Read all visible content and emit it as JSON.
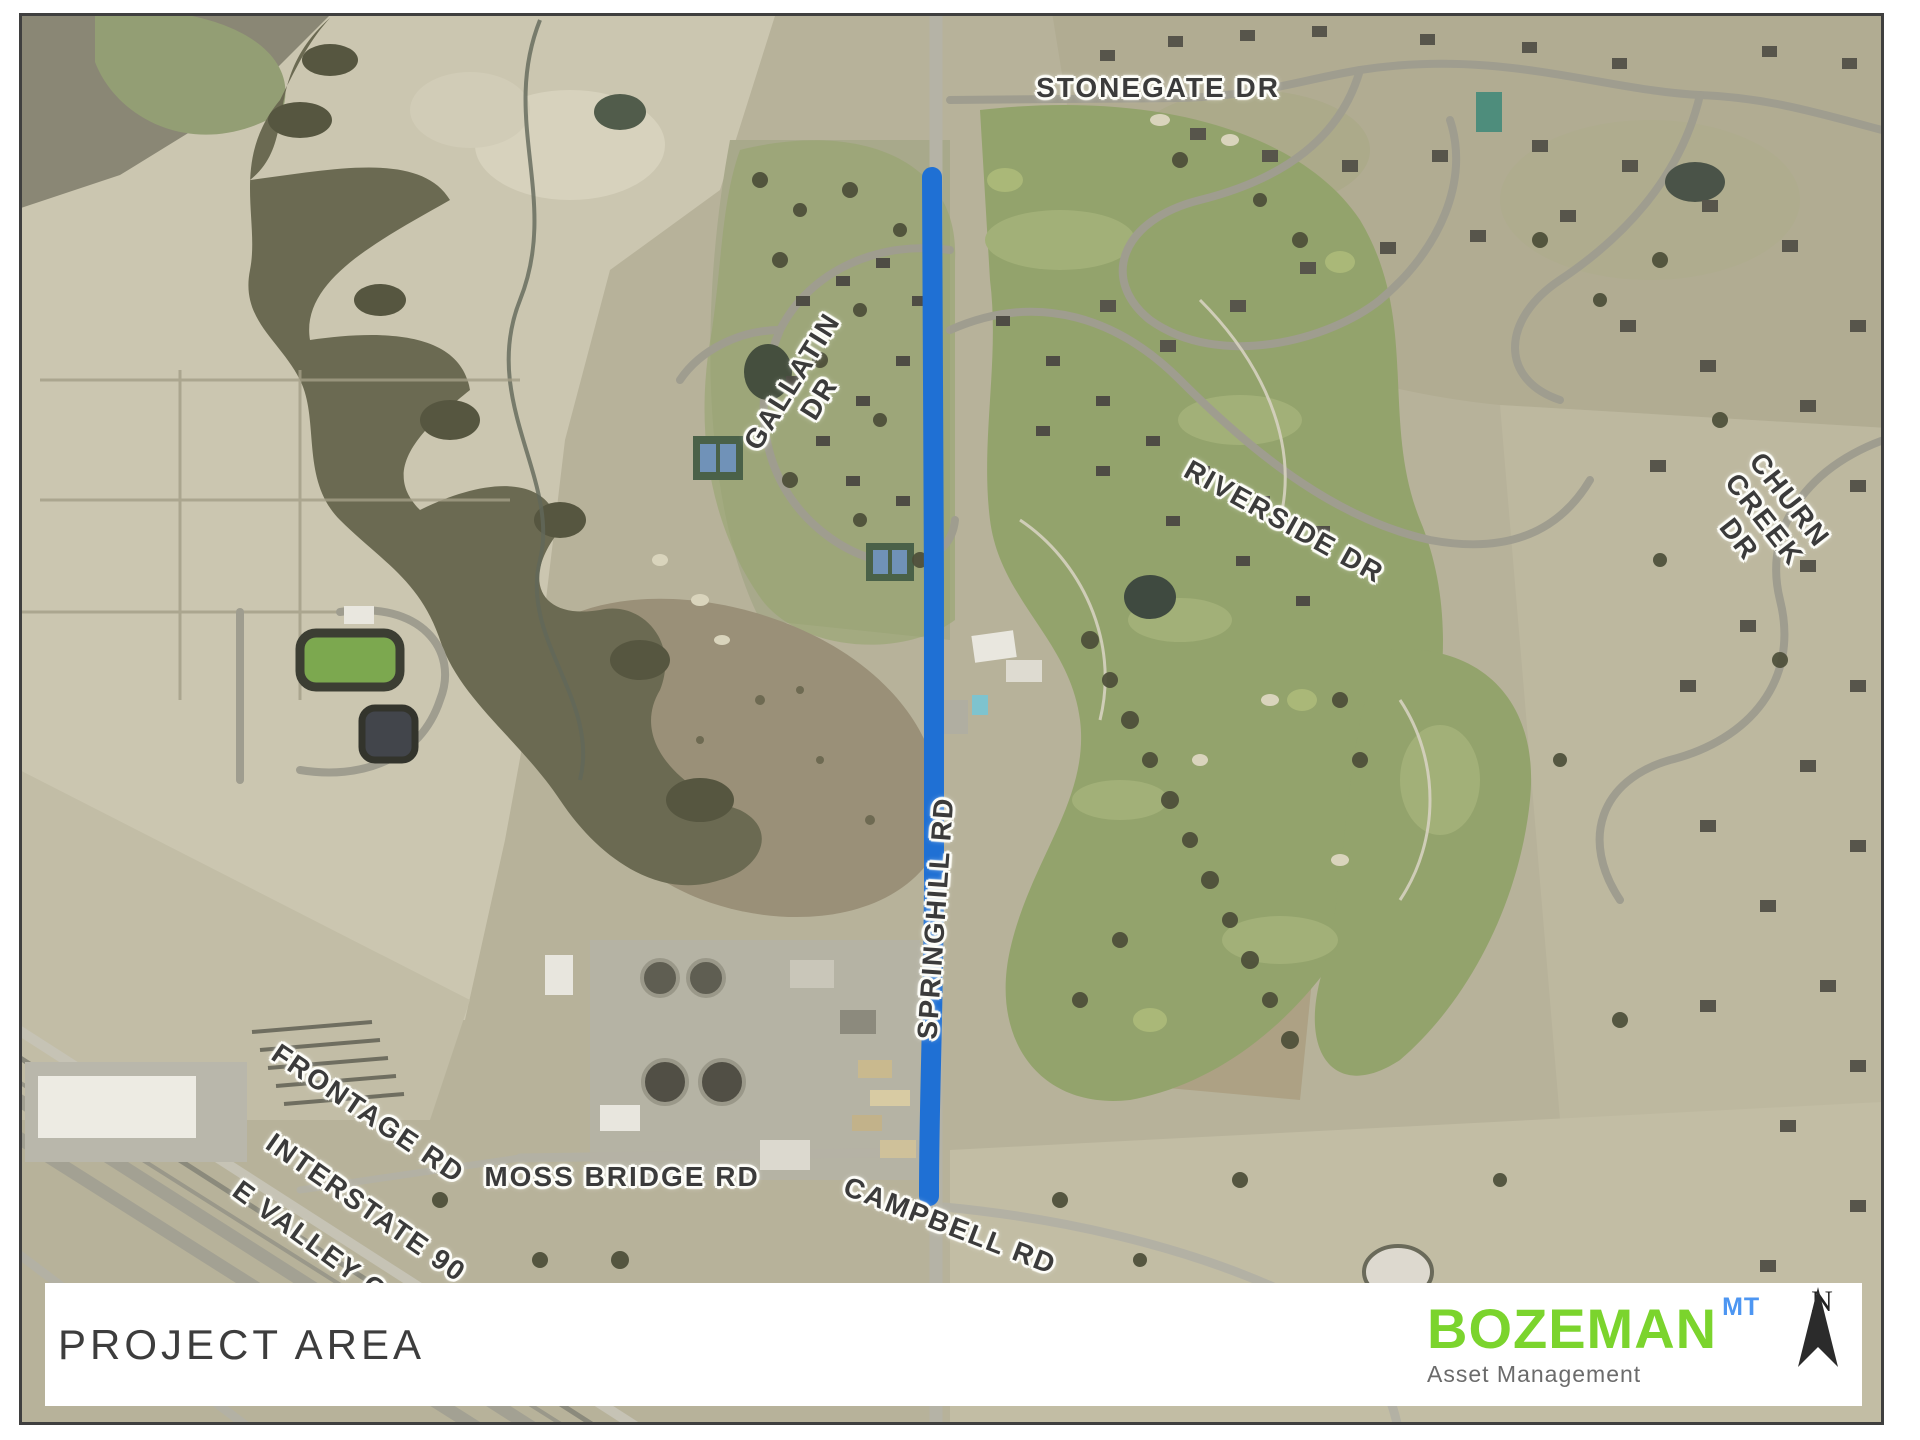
{
  "map": {
    "highlight_color": "#1f70d4",
    "label_color": "#3b3b3b",
    "road_labels": [
      {
        "id": "stonegate",
        "text": "STONEGATE DR"
      },
      {
        "id": "gallatin",
        "text": "GALLATIN\nDR"
      },
      {
        "id": "riverside",
        "text": "RIVERSIDE DR"
      },
      {
        "id": "churn-creek",
        "text": "CHURN\nCREEK DR"
      },
      {
        "id": "springhill",
        "text": "SPRINGHILL RD"
      },
      {
        "id": "frontage",
        "text": "FRONTAGE RD"
      },
      {
        "id": "interstate",
        "text": "INTERSTATE 90"
      },
      {
        "id": "e-valley",
        "text": "E VALLEY CE"
      },
      {
        "id": "moss-bridge",
        "text": "MOSS BRIDGE RD"
      },
      {
        "id": "campbell",
        "text": "CAMPBELL RD"
      }
    ]
  },
  "footer": {
    "title": "PROJECT AREA",
    "logo": {
      "name": "BOZEMAN",
      "superscript": "MT",
      "subtitle": "Asset Management",
      "brand_green": "#7bd42d",
      "brand_blue": "#4d96f2"
    },
    "north_label": "N"
  }
}
